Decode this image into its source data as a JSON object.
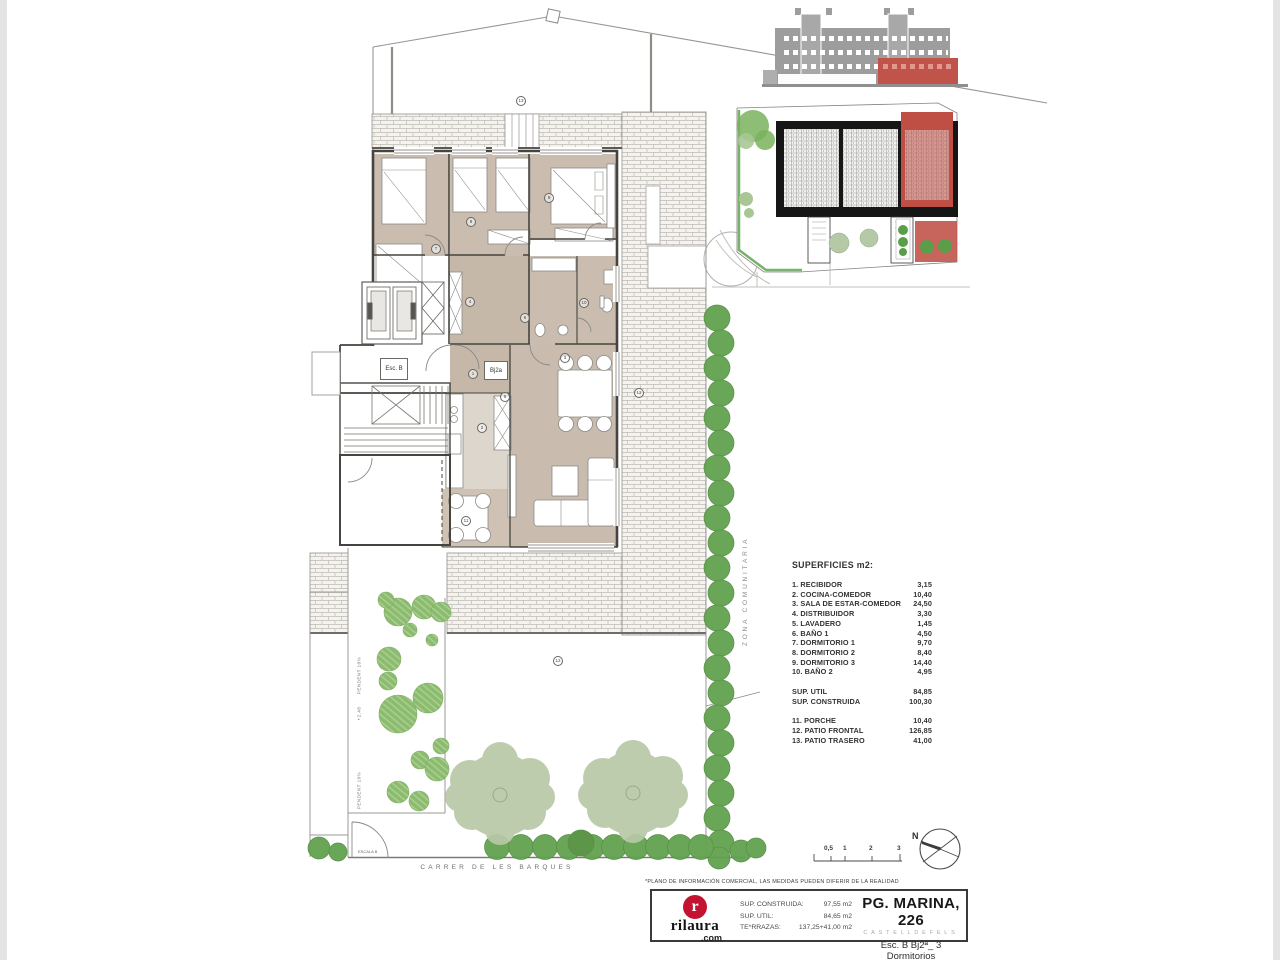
{
  "colors": {
    "accent_red": "#c1544a",
    "logo_red": "#c41332",
    "hedge_green": "#63a24f",
    "tree_green": "#b9c8a8",
    "room_tan": "#cabdaf"
  },
  "plan": {
    "esc_label": "Esc. B",
    "unit_label": "Bj2a",
    "zona_text": "ZONA COMUNITARIA",
    "street_text": "CARRER DE LES BARQUES",
    "ramp_upper_label": "PENDENT 10%",
    "ramp_level": "+2.48",
    "ramp_lower_label": "PENDENT 10%",
    "gate_label": "ESCALA B",
    "markers": [
      {
        "n": "13",
        "x": 520,
        "y": 100
      },
      {
        "n": "7",
        "x": 435,
        "y": 248
      },
      {
        "n": "8",
        "x": 470,
        "y": 221
      },
      {
        "n": "9",
        "x": 548,
        "y": 197
      },
      {
        "n": "4",
        "x": 469,
        "y": 301
      },
      {
        "n": "6",
        "x": 524,
        "y": 317
      },
      {
        "n": "10",
        "x": 583,
        "y": 302
      },
      {
        "n": "5",
        "x": 504,
        "y": 396
      },
      {
        "n": "1",
        "x": 472,
        "y": 373
      },
      {
        "n": "2",
        "x": 481,
        "y": 427
      },
      {
        "n": "3",
        "x": 564,
        "y": 357
      },
      {
        "n": "11",
        "x": 465,
        "y": 520
      },
      {
        "n": "12",
        "x": 638,
        "y": 392
      },
      {
        "n": "12",
        "x": 557,
        "y": 660
      }
    ]
  },
  "superficies": {
    "title": "SUPERFICIES m2:",
    "rooms": [
      {
        "label": "1. RECIBIDOR",
        "value": "3,15"
      },
      {
        "label": "2. COCINA-COMEDOR",
        "value": "10,40"
      },
      {
        "label": "3. SALA DE ESTAR-COMEDOR",
        "value": "24,50"
      },
      {
        "label": "4. DISTRIBUIDOR",
        "value": "3,30"
      },
      {
        "label": "5. LAVADERO",
        "value": "1,45"
      },
      {
        "label": "6. BAÑO 1",
        "value": "4,50"
      },
      {
        "label": "7. DORMITORIO 1",
        "value": "9,70"
      },
      {
        "label": "8. DORMITORIO 2",
        "value": "8,40"
      },
      {
        "label": "9. DORMITORIO 3",
        "value": "14,40"
      },
      {
        "label": "10. BAÑO 2",
        "value": "4,95"
      }
    ],
    "totals": [
      {
        "label": "SUP. UTIL",
        "value": "84,85"
      },
      {
        "label": "SUP. CONSTRUIDA",
        "value": "100,30"
      }
    ],
    "exterior": [
      {
        "label": "11. PORCHE",
        "value": "10,40"
      },
      {
        "label": "12. PATIO FRONTAL",
        "value": "126,85"
      },
      {
        "label": "13. PATIO TRASERO",
        "value": "41,00"
      }
    ]
  },
  "scalebar": {
    "labels": [
      {
        "text": "0,5",
        "x": 824
      },
      {
        "text": "1",
        "x": 843
      },
      {
        "text": "2",
        "x": 869
      },
      {
        "text": "3",
        "x": 897
      }
    ],
    "north": "N"
  },
  "footer": {
    "disclaimer": "*PLANO DE INFORMACIÓN COMERCIAL, LAS MEDIDAS PUEDEN DIFERIR DE LA REALIDAD",
    "logo": {
      "initial": "r",
      "name": "rilaura",
      "tld": ".com"
    },
    "metrics": [
      {
        "label": "SUP. CONSTRUIDA:",
        "value": "97,55 m2"
      },
      {
        "label": "SUP. UTIL:",
        "value": "84,65 m2"
      },
      {
        "label": "TE*RRAZAS:",
        "value": "137,25+41,00 m2"
      }
    ],
    "title": "PG. MARINA, 226",
    "subtitle": "CASTELLDEFELS",
    "unit": "Esc. B Bj2ª_ 3 Dormitorios"
  }
}
